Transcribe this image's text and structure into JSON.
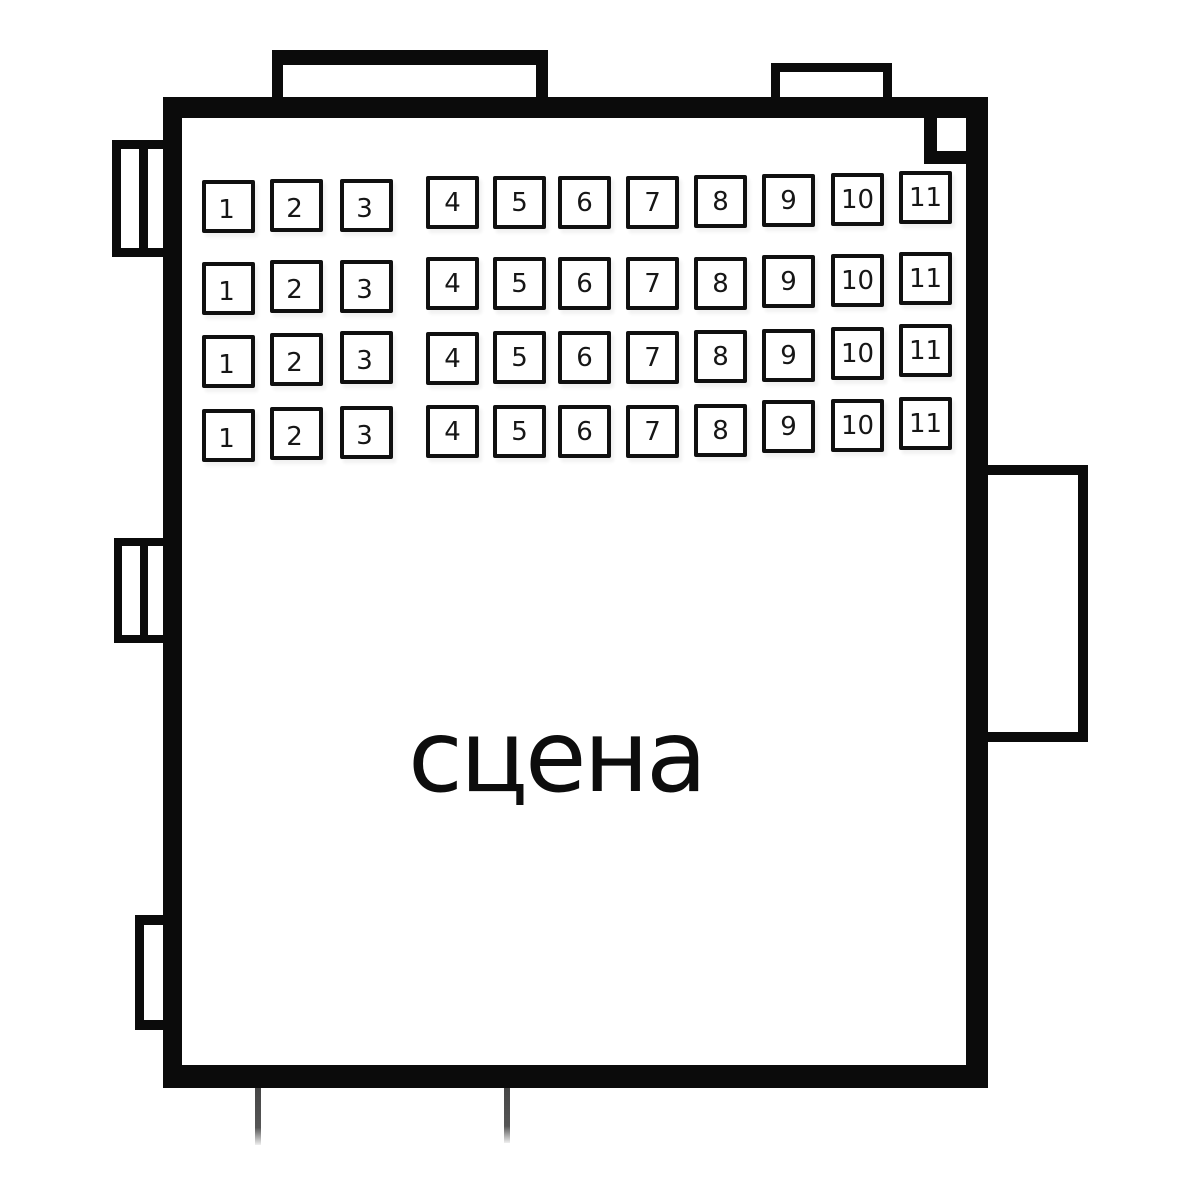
{
  "stage": {
    "label": "сцена"
  },
  "seating": {
    "rows": [
      {
        "seats": [
          "1",
          "2",
          "3",
          "4",
          "5",
          "6",
          "7",
          "8",
          "9",
          "10",
          "11"
        ]
      },
      {
        "seats": [
          "1",
          "2",
          "3",
          "4",
          "5",
          "6",
          "7",
          "8",
          "9",
          "10",
          "11"
        ]
      },
      {
        "seats": [
          "1",
          "2",
          "3",
          "4",
          "5",
          "6",
          "7",
          "8",
          "9",
          "10",
          "11"
        ]
      },
      {
        "seats": [
          "1",
          "2",
          "3",
          "4",
          "5",
          "6",
          "7",
          "8",
          "9",
          "10",
          "11"
        ]
      }
    ]
  },
  "colors": {
    "ink": "#0b0b0b",
    "background": "#ffffff",
    "stub_line": "#4f4f4f"
  }
}
